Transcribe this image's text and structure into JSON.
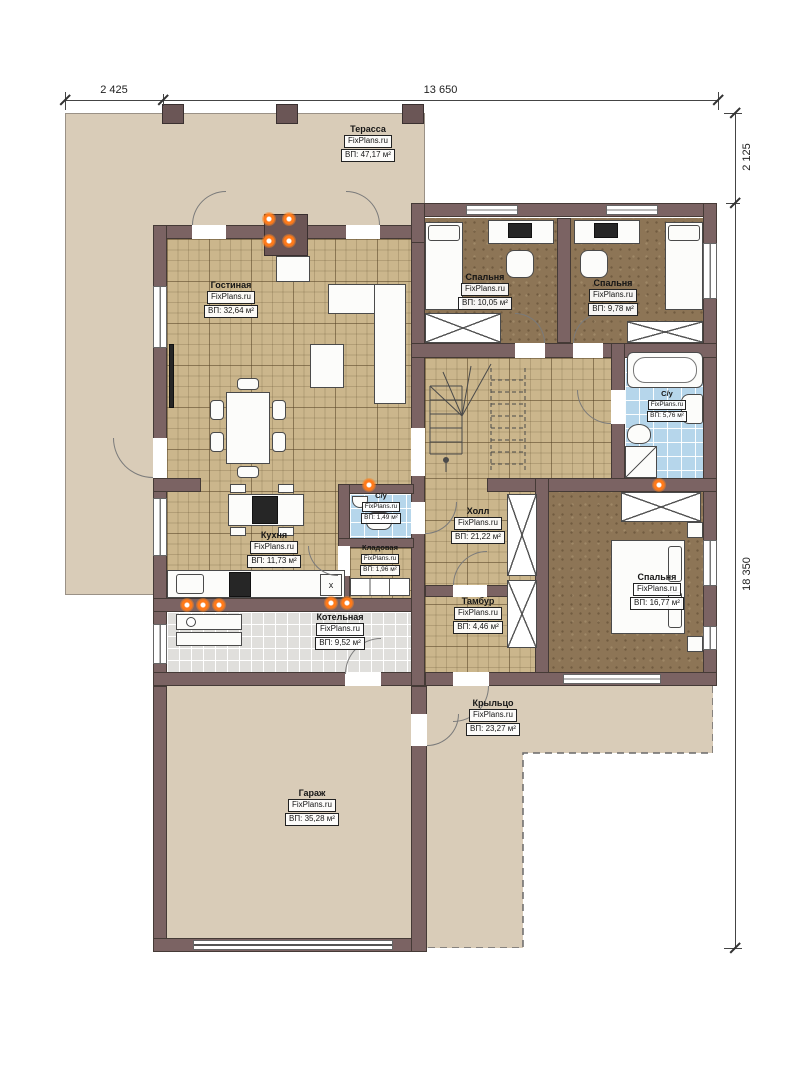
{
  "brand": "FixPlans.ru",
  "x_mark": "x",
  "dims": {
    "top_left": "2 425",
    "top_main": "13 650",
    "right_top": "2 125",
    "right_main": "18 350"
  },
  "rooms": [
    {
      "id": "terrace",
      "name": "Терасса",
      "area": "ВП: 47,17 м²"
    },
    {
      "id": "living",
      "name": "Гостиная",
      "area": "ВП: 32,64 м²"
    },
    {
      "id": "bedroom1",
      "name": "Спальня",
      "area": "ВП: 10,05 м²"
    },
    {
      "id": "bedroom2",
      "name": "Спальня",
      "area": "ВП: 9,78 м²"
    },
    {
      "id": "bath",
      "name": "С/у",
      "area": "ВП: 5,76 м²"
    },
    {
      "id": "wc",
      "name": "С/у",
      "area": "ВП: 1,49 м²"
    },
    {
      "id": "kitchen",
      "name": "Кухня",
      "area": "ВП: 11,73 м²"
    },
    {
      "id": "pantry",
      "name": "Кладовая",
      "area": "ВП: 1,96 м²"
    },
    {
      "id": "hall",
      "name": "Холл",
      "area": "ВП: 21,22 м²"
    },
    {
      "id": "tambour",
      "name": "Тамбур",
      "area": "ВП: 4,46 м²"
    },
    {
      "id": "bedroom3",
      "name": "Спальня",
      "area": "ВП: 16,77 м²"
    },
    {
      "id": "boiler",
      "name": "Котельная",
      "area": "ВП: 9,52 м²"
    },
    {
      "id": "garage",
      "name": "Гараж",
      "area": "ВП: 35,28 м²"
    },
    {
      "id": "porch",
      "name": "Крыльцо",
      "area": "ВП: 23,27 м²"
    }
  ]
}
